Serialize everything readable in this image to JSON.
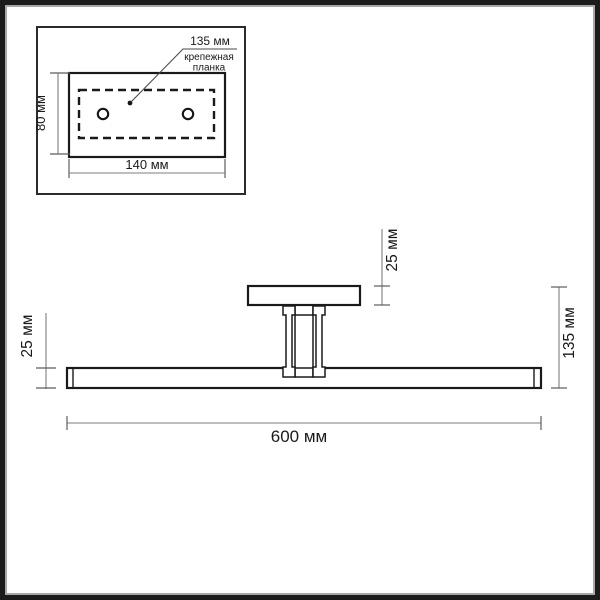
{
  "colors": {
    "ink": "#1a1a1a",
    "dim_line": "#7d7d7d",
    "frame": "#1c1c1c",
    "frame_inner": "#a8a8a8",
    "background": "#ffffff"
  },
  "inset": {
    "leader_dim_label": "135 мм",
    "plate_name_line1": "крепежная",
    "plate_name_line2": "планка",
    "height_dim": "80 мм",
    "width_dim": "140 мм"
  },
  "side_view": {
    "bar_thickness_dim": "25 мм",
    "canopy_height_dim": "25 мм",
    "total_height_dim": "135 мм",
    "total_width_dim": "600 мм"
  }
}
